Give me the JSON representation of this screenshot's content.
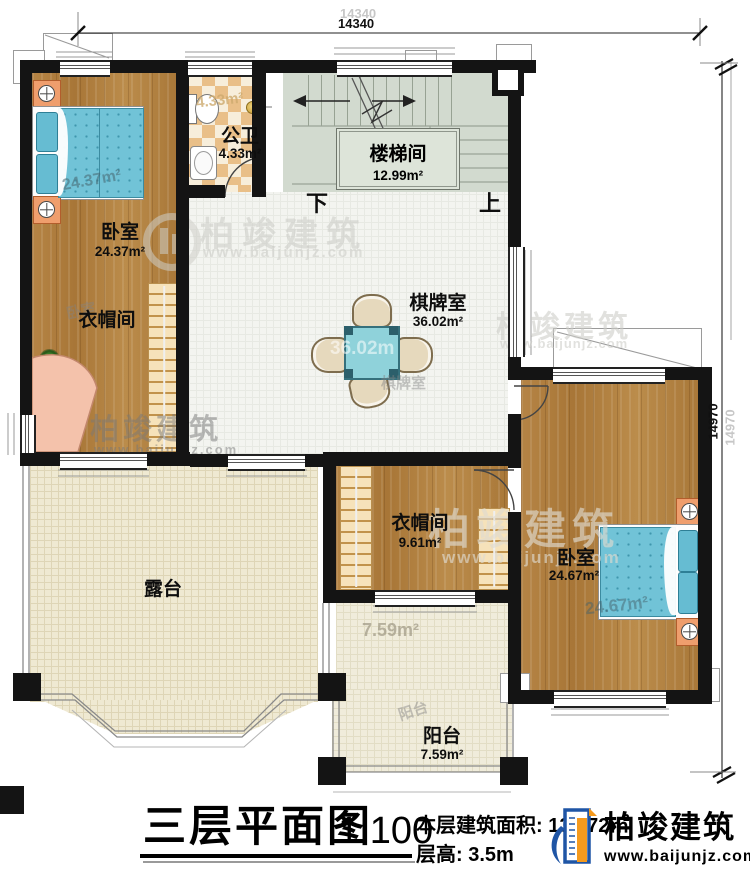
{
  "plan": {
    "title": "三层平面图",
    "scale": "1:100",
    "area_label": "本层建筑面积:",
    "area_value": "137.72㎡",
    "floor_height_label": "层高:",
    "floor_height_value": "3.5m"
  },
  "brand": {
    "name": "柏竣建筑",
    "url": "www.baijunjz.com"
  },
  "dims": {
    "top": "14340",
    "right": "14970"
  },
  "rooms": {
    "bedroom_left": {
      "name": "卧室",
      "area": "24.37m²"
    },
    "bathroom": {
      "name": "公卫",
      "area": "4.33m²"
    },
    "stairwell": {
      "name": "楼梯间",
      "area": "12.99m²"
    },
    "game_room": {
      "name": "棋牌室",
      "area": "36.02m²"
    },
    "cloakroom_left": {
      "name": "衣帽间"
    },
    "cloakroom_right": {
      "name": "衣帽间",
      "area": "9.61m²"
    },
    "bedroom_right": {
      "name": "卧室",
      "area": "24.67m²"
    },
    "terrace": {
      "name": "露台"
    },
    "balcony": {
      "name": "阳台",
      "area": "7.59m²"
    }
  },
  "stairs": {
    "down": "下",
    "up": "上"
  },
  "ghosts": {
    "bedroom_left_area": "24.37m²",
    "bedroom_left_name": "卧室",
    "bathroom_area": "4.33m²",
    "game_table_area": "36.02m",
    "game_name": "棋牌室",
    "bedroom_right_area": "24.67m²",
    "balcony_name": "阳台",
    "balcony_area": "7.59m²",
    "dim_top": "14340",
    "dim_right": "14970"
  },
  "colors": {
    "brand_blue": "#1f55a5",
    "brand_orange": "#f59a1d",
    "wall": "#141414",
    "bed_teal": "#6fc2d6"
  }
}
